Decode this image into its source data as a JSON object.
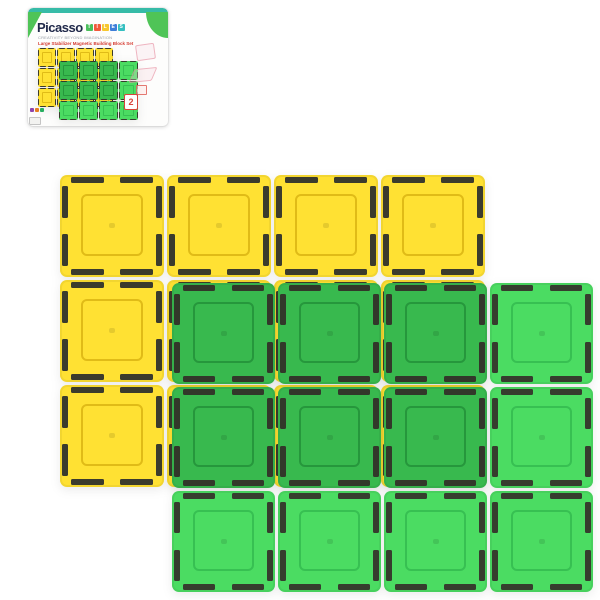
{
  "scene": {
    "description": "Product photo of translucent magnetic building tiles on white background with retail box thumbnail in top-left corner",
    "yellow_tile_count": 12,
    "green_tile_count": 12
  },
  "box": {
    "brand": "Picasso",
    "brand_color": "#20294a",
    "brand_blocks": [
      {
        "letter": "T",
        "color": "#4CBF5C"
      },
      {
        "letter": "I",
        "color": "#F15A3B"
      },
      {
        "letter": "L",
        "color": "#F7C72F"
      },
      {
        "letter": "E",
        "color": "#3E7ED8"
      },
      {
        "letter": "S",
        "color": "#35BFC0"
      }
    ],
    "tagline": "CREATIVITY BEYOND IMAGINATION",
    "product_name": "Large Stabilizer Magnetic Building Block Set",
    "badge_number": "2",
    "topband_color": "#36BBA7",
    "corner_accent_color": "#4FC457",
    "mini_mark_colors": [
      "#8E44AD",
      "#E67E22",
      "#27AE60"
    ]
  },
  "tiles": {
    "yellow": {
      "fill": "#FFE133",
      "line": "rgba(198,156,0,0.55)",
      "magnet": "#3B3B2D"
    },
    "green_dark": {
      "fill": "#38B94E",
      "line": "rgba(18,110,40,0.45)",
      "magnet": "#32382A"
    },
    "green_light": {
      "fill": "#4BDC62",
      "line": "rgba(25,150,60,0.40)",
      "magnet": "#363D2E"
    }
  },
  "main_grids": {
    "yellow": {
      "x": 60,
      "y": 175,
      "cols": 4,
      "rows": 3,
      "pitchX": 107,
      "pitchY": 105,
      "tileW": 104,
      "tileH": 102,
      "variant": "yellow"
    },
    "green": {
      "x": 172,
      "y": 283,
      "cols": 4,
      "rows": 3,
      "pitchX": 106,
      "pitchY": 104,
      "tileW": 103,
      "tileH": 101,
      "variant": "green",
      "dark_cols": 3,
      "dark_rows": 2
    }
  },
  "mini_grids": {
    "yellow": {
      "x": 10,
      "y": 40,
      "cols": 4,
      "rows": 3,
      "pitchX": 19,
      "pitchY": 20,
      "tileW": 18,
      "tileH": 19,
      "variant": "yellow"
    },
    "green": {
      "x": 31,
      "y": 53,
      "cols": 4,
      "rows": 3,
      "pitchX": 20,
      "pitchY": 20,
      "tileW": 19,
      "tileH": 19,
      "variant": "green",
      "dark_cols": 3,
      "dark_rows": 2
    }
  }
}
